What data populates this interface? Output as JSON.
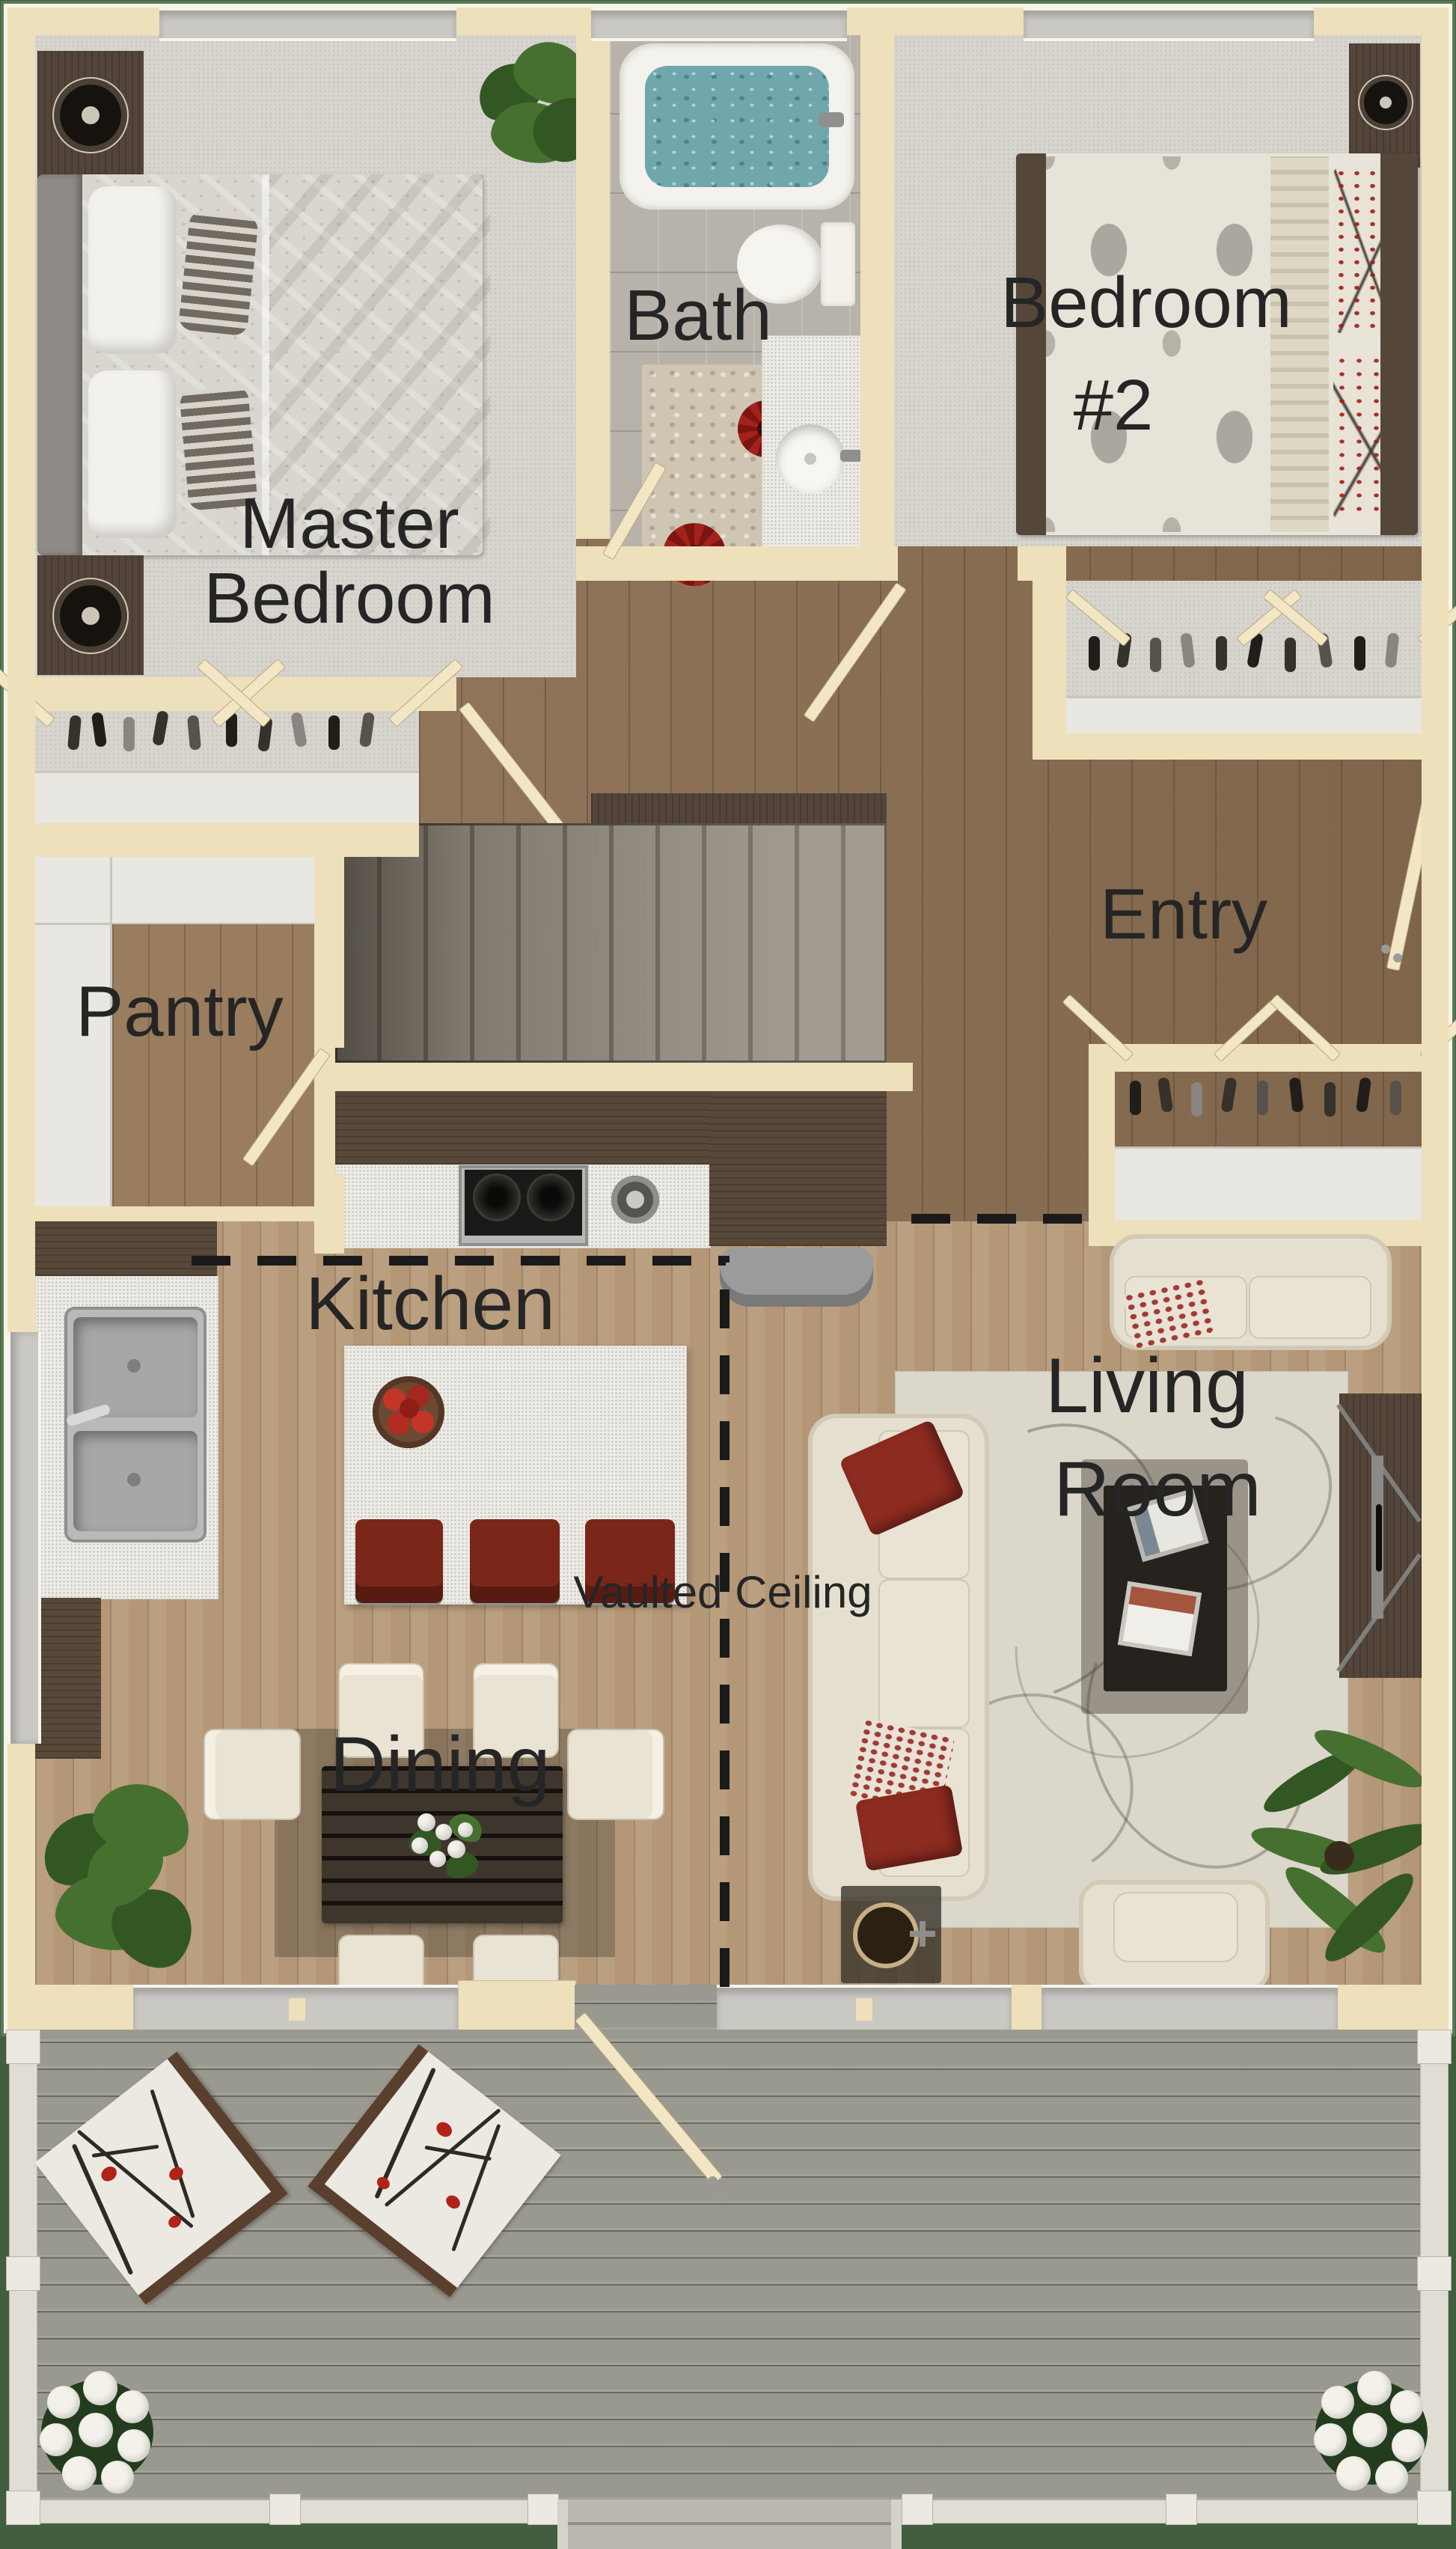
{
  "title": "Single-level house floor plan, top-down 3D render",
  "labels": {
    "master": {
      "line1": "Master",
      "line2": "Bedroom"
    },
    "bath": "Bath",
    "bedroom2": {
      "line1": "Bedroom",
      "line2": "#2"
    },
    "entry": "Entry",
    "pantry": "Pantry",
    "kitchen": "Kitchen",
    "dining": "Dining",
    "living": {
      "line1": "Living",
      "line2": "Room"
    },
    "vaulted": "Vaulted Ceiling"
  },
  "colors": {
    "background_green": "#415e3e",
    "wall_cream": "#eee0bb",
    "carpet_gray": "#d7d4ce",
    "bath_tile": "#b7b3aa",
    "hall_walnut": "#8a6e51",
    "greatroom_oak": "#b49776",
    "deck_gray": "#9a998f",
    "counter_white": "#edebe6",
    "cabinet_darkwood": "#57483a",
    "accent_red": "#7a2619",
    "label_text": "#252525",
    "tub_water_blue": "#6fa7ad"
  }
}
